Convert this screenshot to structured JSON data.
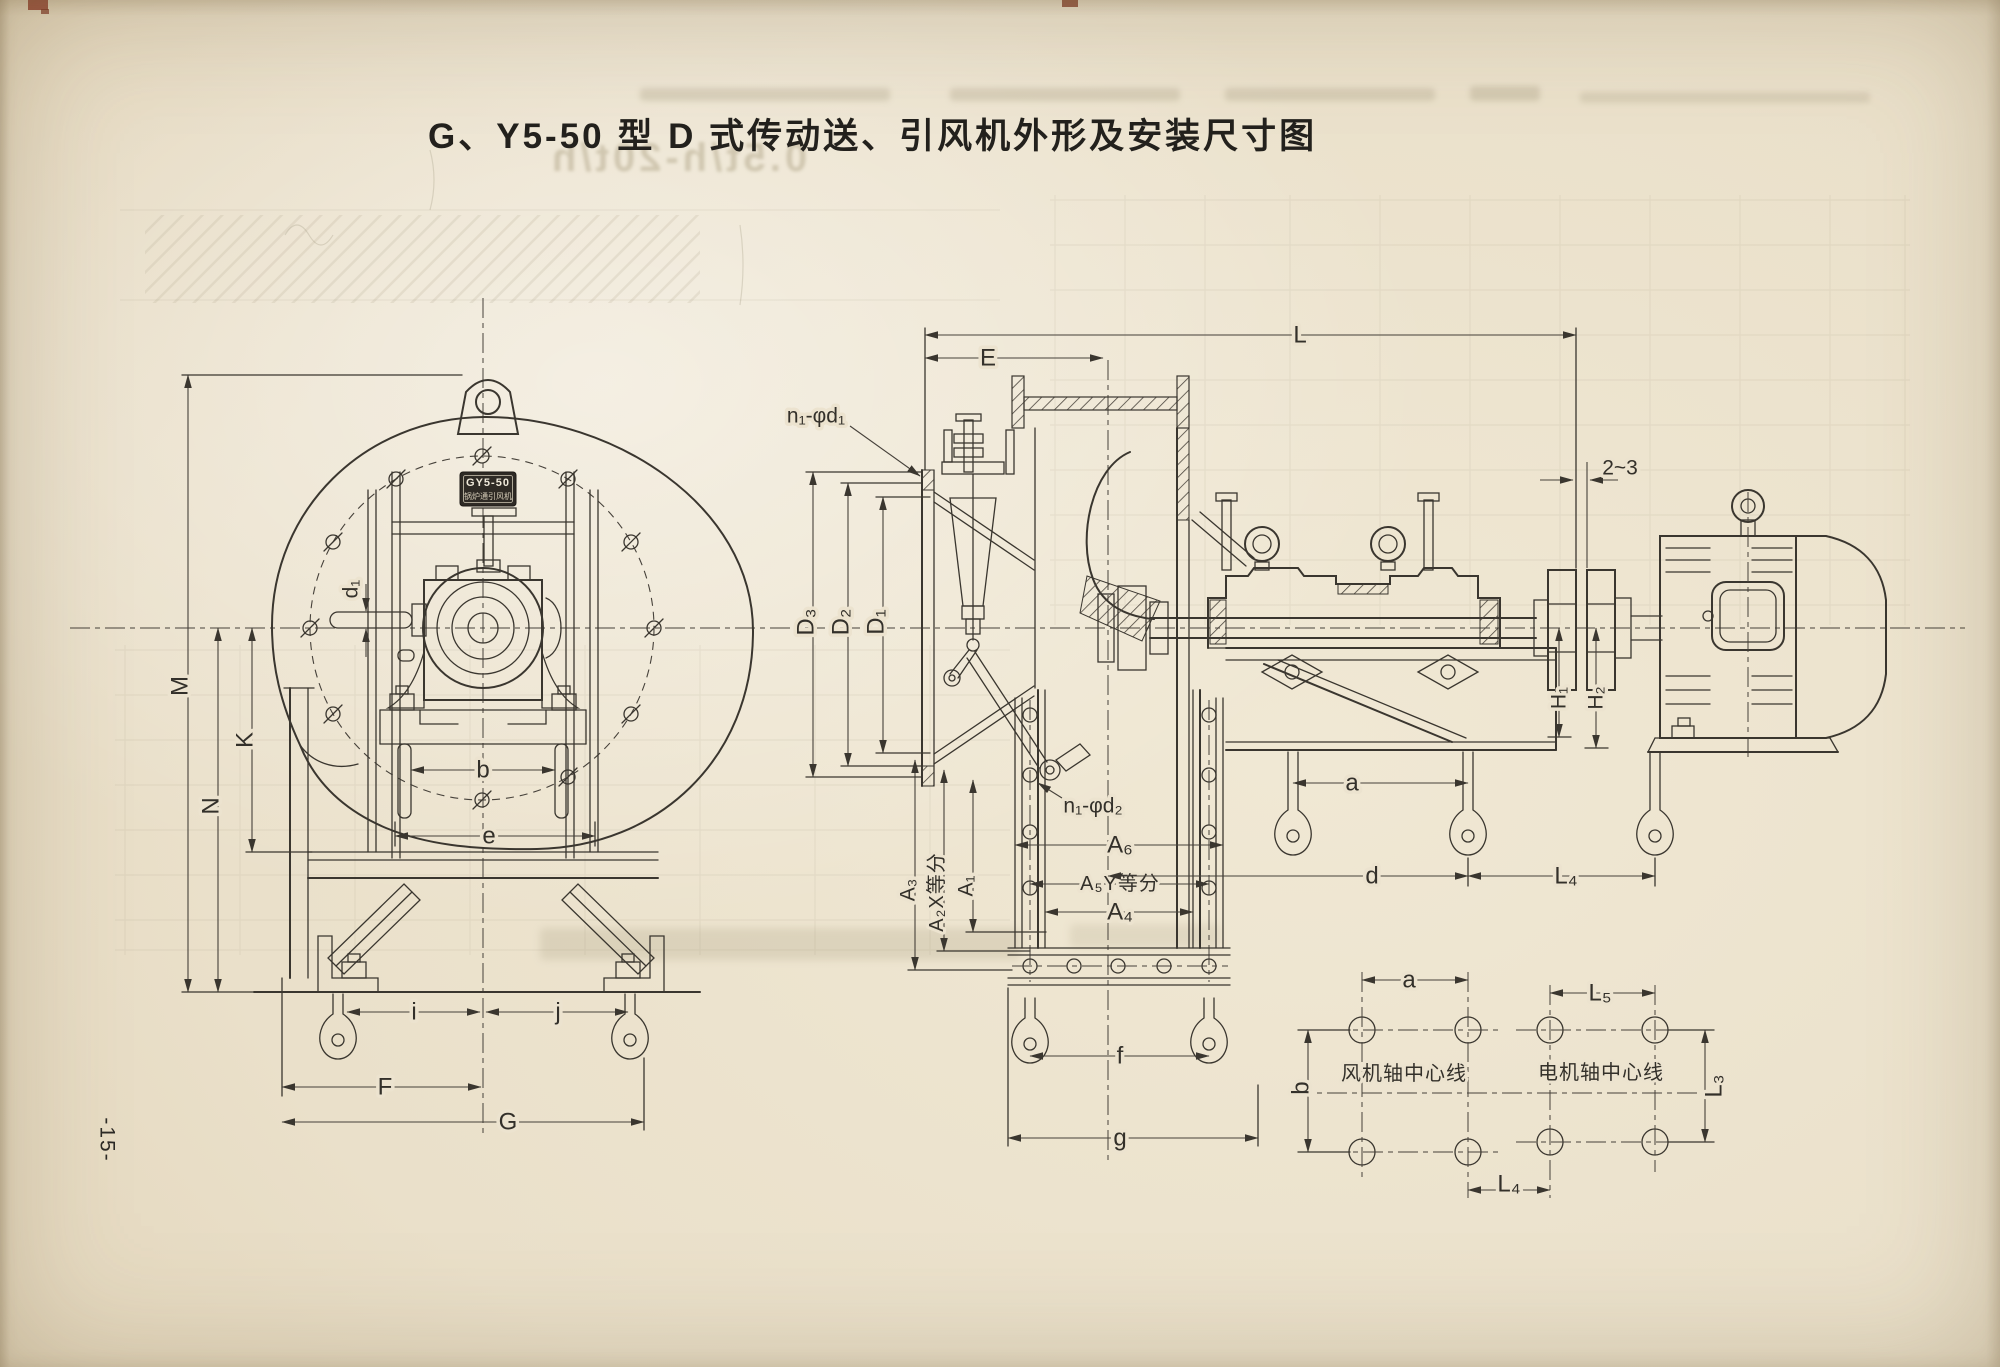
{
  "page": {
    "title": "G、Y5-50 型 D 式传动送、引风机外形及安装尺寸图",
    "page_number": "-15-"
  },
  "ghost": {
    "bleed_text": "0.5t/h-20t/h"
  },
  "front_view": {
    "nameplate": {
      "line1": "GY5-50",
      "line2": "锅炉通引风机"
    },
    "labels": {
      "M": "M",
      "K": "K",
      "N": "N",
      "d1": "d₁",
      "b": "b",
      "e": "e",
      "i": "i",
      "j": "j",
      "F": "F",
      "G": "G"
    }
  },
  "side_view": {
    "labels": {
      "L": "L",
      "E": "E",
      "n1_d1": "n₁-φd₁",
      "n1_d2": "n₁-φd₂",
      "D3": "D₃",
      "D2": "D₂",
      "D1": "D₁",
      "A6": "A₆",
      "A5": "A₅Y等分",
      "A4": "A₄",
      "A3": "A₃",
      "A2": "A₂X等分",
      "A1": "A₁",
      "f": "f",
      "g": "g",
      "a": "a",
      "d": "d",
      "L4": "L₄",
      "H1": "H₁",
      "H2": "H₂",
      "gap": "2~3"
    }
  },
  "foundation_plan": {
    "labels": {
      "a": "a",
      "L5": "L₅",
      "L4": "L₄",
      "b": "b",
      "L3": "L₃"
    },
    "fan_axis_label": "风机轴中心线",
    "motor_axis_label": "电机轴中心线"
  }
}
